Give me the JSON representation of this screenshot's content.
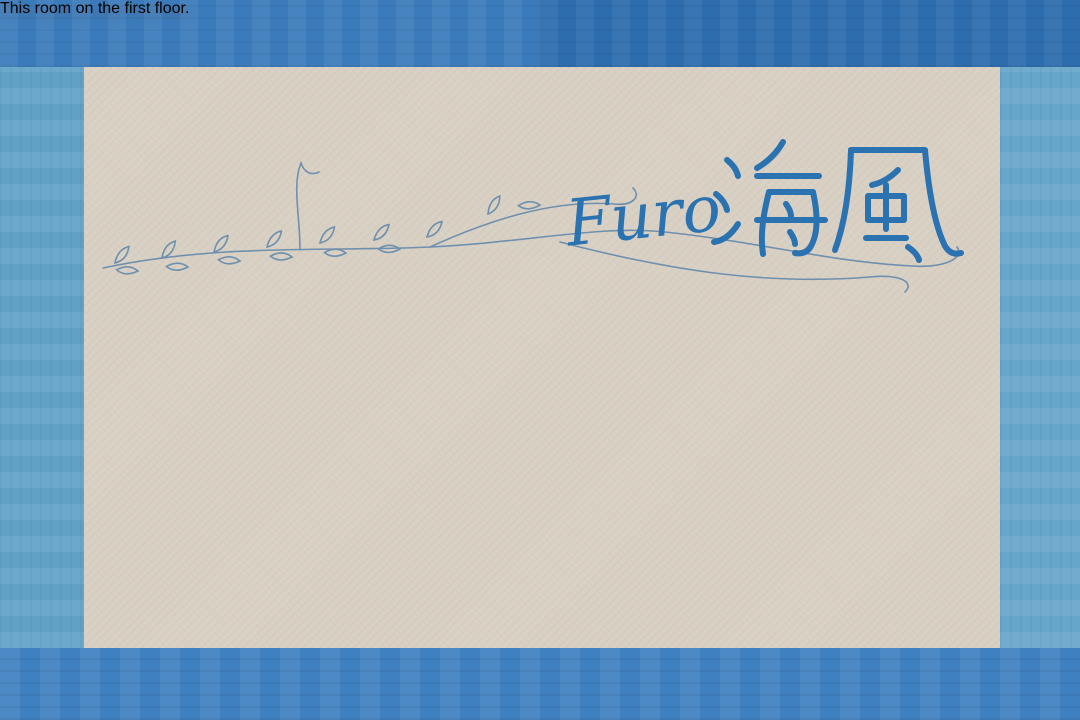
{
  "banner": {
    "text": "This room on the first floor."
  },
  "title": {
    "romaji": "Furo",
    "kanji": "海風"
  },
  "colors": {
    "border_top": "#2f73b7",
    "border_bottom": "#3f80c1",
    "border_left": "#61a1c7",
    "border_right": "#66a6cb",
    "canvas_beige": "#d9d0c4",
    "accent_blue": "#2a72b0",
    "ribbon_light_blue": "#d5e5f3",
    "ribbon_white": "#fafaf8",
    "wall_outline": "#53463a",
    "concrete_gray": "#b8bbbd",
    "wood_floor": "#d8b87a",
    "rug_green": "#186049",
    "table_brown": "#8a6a42",
    "bed_white": "#f3f3ef"
  },
  "floor_plan": {
    "elements": [
      "entry-concrete-area",
      "kitchen-counter",
      "stove",
      "kitchen-sink",
      "refrigerator",
      "dining-table",
      "dining-chairs",
      "bench-seat",
      "tv",
      "toilet-room",
      "toilet",
      "partition-wall",
      "wood-bench",
      "storage-box",
      "plaid-rug",
      "double-bed-1",
      "double-bed-2",
      "pillows",
      "bathtub",
      "washing-machine",
      "laundry-unit",
      "wash-basin",
      "changing-room-floor",
      "step"
    ]
  }
}
